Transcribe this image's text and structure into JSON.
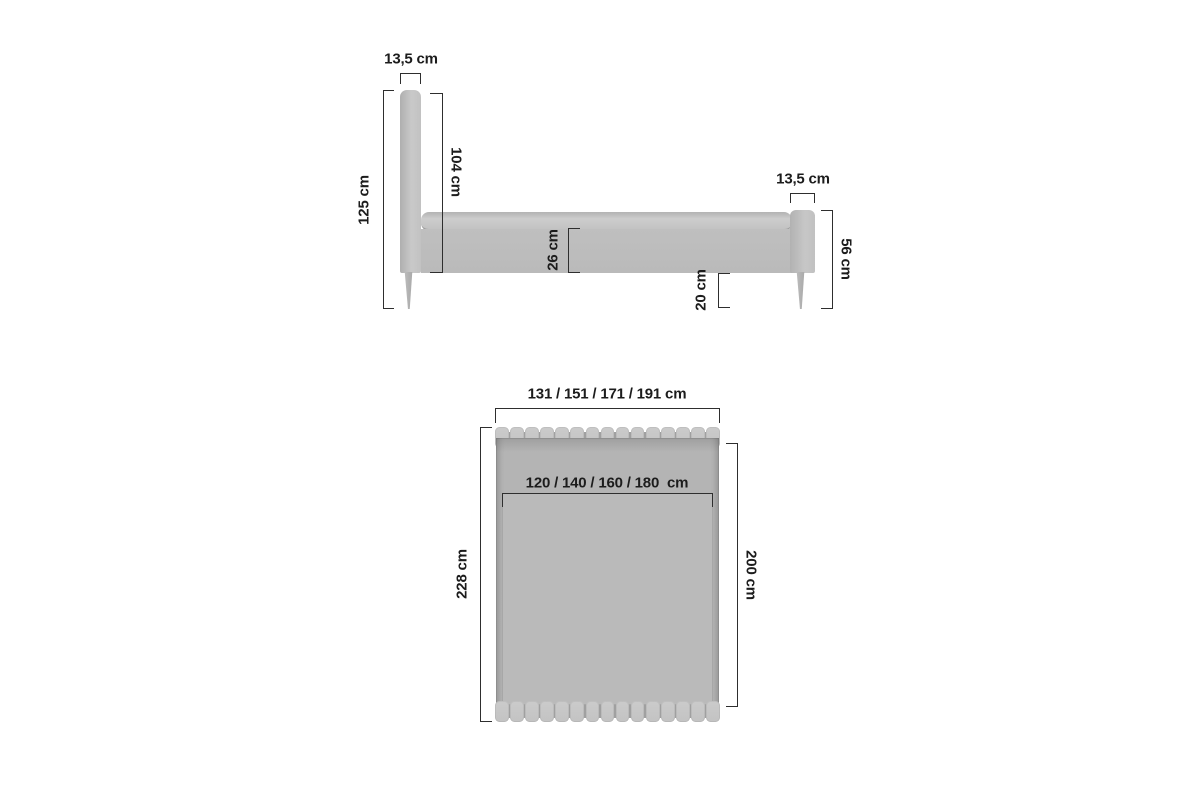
{
  "side_view": {
    "headboard_width": "13,5 cm",
    "total_height": "125 cm",
    "headboard_panel_height": "104 cm",
    "frame_side_height": "26 cm",
    "underbed_clearance": "20 cm",
    "footboard_width": "13,5 cm",
    "footboard_height": "56 cm"
  },
  "top_view": {
    "overall_widths": "131 / 151 / 171 / 191 cm",
    "mattress_widths": "120 / 140 / 160 / 180  cm",
    "overall_length": "228 cm",
    "mattress_length": "200 cm",
    "slat_count": 15
  },
  "colors": {
    "background": "#ffffff",
    "upholstery_light": "#c9c9c9",
    "upholstery_mid": "#bcbcbc",
    "upholstery_shadow": "#9e9e9e",
    "dimension_line": "#2e2e2e",
    "text": "#1c1c1c"
  }
}
